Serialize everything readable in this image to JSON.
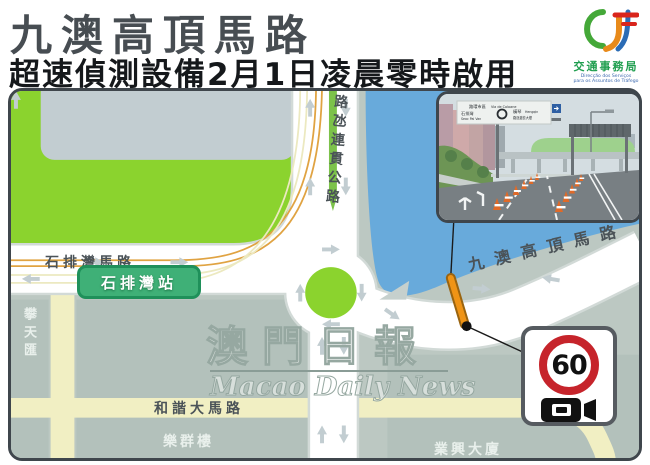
{
  "header": {
    "title": "九澳高頂馬路",
    "subtitle": "超速偵測設備2月1日凌晨零時啟用",
    "logo": {
      "org": "交通事務局",
      "org_pt1": "Direcção dos Serviços",
      "org_pt2": "para os Assuntos de Tráfego"
    }
  },
  "map": {
    "roads": {
      "seac_pai_van_road": "石排灣馬路",
      "istmo_highway": "路氹連貫公路",
      "ka_ho_alto_road": "九澳高頂馬路",
      "harmonia_avenue": "和諧大馬路"
    },
    "station": "石排灣站",
    "buildings": {
      "pan_tin_wui": "攀天匯",
      "lok_kuan": "樂群樓",
      "ip_heng": "業興大廈"
    },
    "speed_sign": {
      "limit": "60"
    },
    "colors": {
      "green_area": "#8bd32e",
      "water": "#68aadb",
      "minor_road": "#f1efc3",
      "station_green": "#3fb077",
      "camera_marker_orange": "#ef9416",
      "speed_sign_red": "#c6242b"
    }
  },
  "photo": {
    "gantry_sign": {
      "top": "路環市區",
      "top_pt": "Via de Coloane",
      "left": "石排灣",
      "left_pt": "Seac Pai Van",
      "right": "橫琴",
      "right_pt": "Hengqin",
      "right2": "路氹邊檢大樓"
    }
  },
  "watermark": {
    "zh": "澳門日報",
    "en": "Macao Daily News"
  }
}
